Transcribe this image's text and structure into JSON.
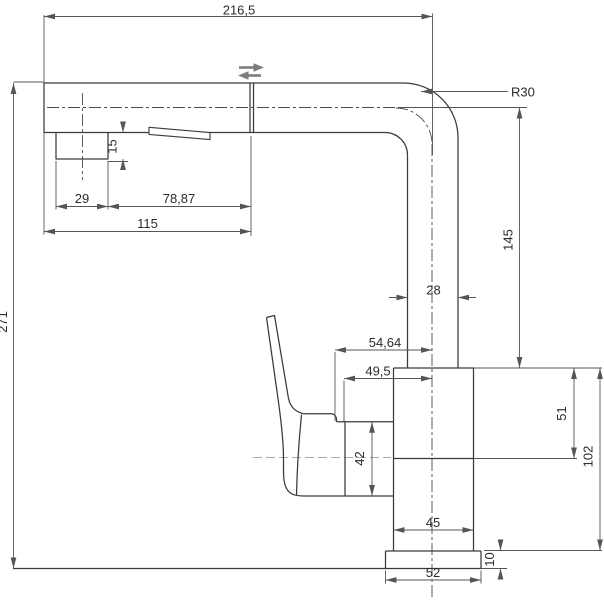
{
  "drawing": {
    "kind": "technical dimension drawing",
    "subject": "pull-out kitchen mixer faucet, side view",
    "colors": {
      "object_line": "#3a3a3a",
      "dimension_line": "#555555",
      "text": "#2b2b2b",
      "pullout_arrow_gray": "#7d7d7d",
      "handle_centerline_gray": "#ababab"
    },
    "dims": {
      "overall_width": "216,5",
      "bend_radius": "R30",
      "overall_height": "271",
      "aerator_depth": "15",
      "aerator_offset": "29",
      "spout_mid_section": "78,87",
      "spout_reach": "115",
      "riser_height": "145",
      "riser_width": "28",
      "handle_tip_offset": "54,64",
      "handle_base_offset": "49,5",
      "handle_mount_height": "42",
      "body_upper_height": "51",
      "body_height": "102",
      "body_width": "45",
      "base_height": "10",
      "base_width": "52"
    },
    "icons": {
      "pull_out_spray": "double-arrow-left-right"
    }
  }
}
